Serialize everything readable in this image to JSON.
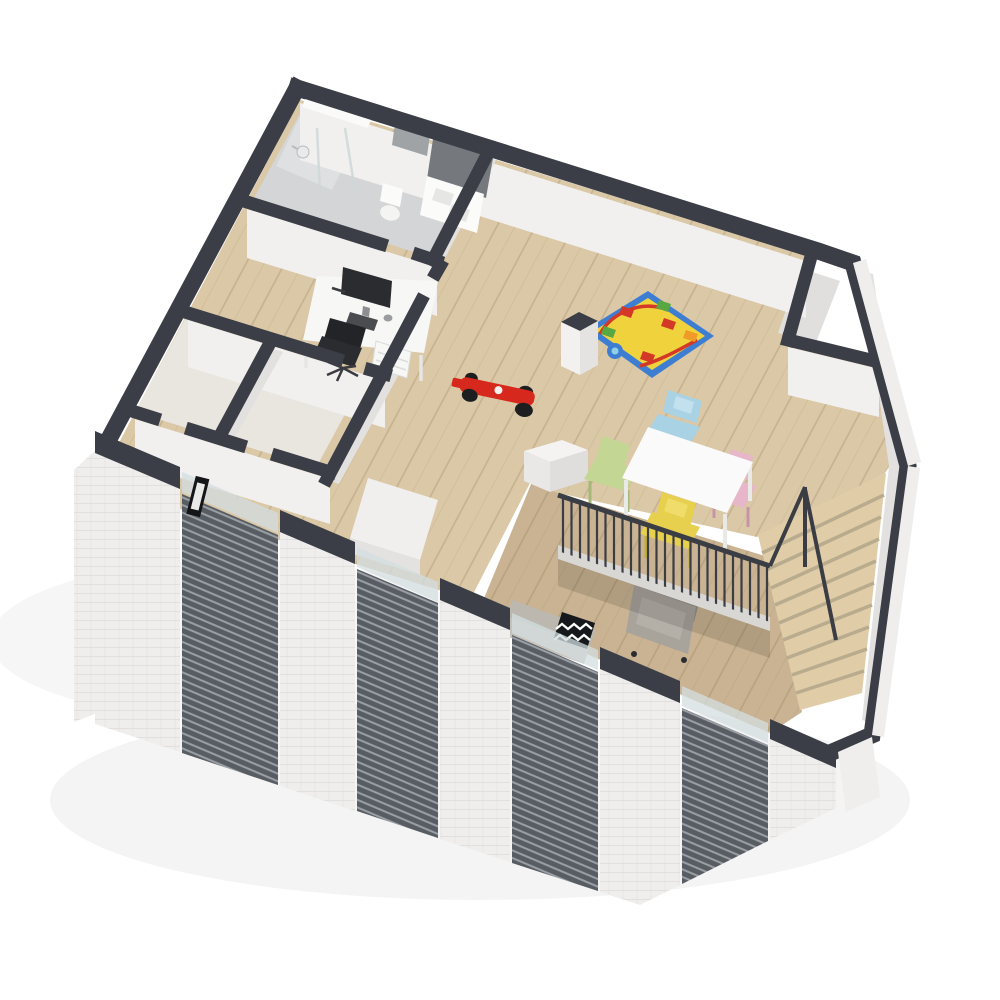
{
  "description": "3D isometric cutaway floor plan rendering of an apartment upper floor with bathroom, office, two empty rooms, play and dining area, mezzanine balustrade, staircase, lower lounge and a louvered front facade",
  "palette": {
    "wallCap": "#3b3e46",
    "wallFace": "#f1f0ee",
    "wallFaceShade": "#e2e1df",
    "exteriorWhite": "#efeeec",
    "floorWood": "#dbc8a6",
    "floorWoodLower": "#c9b392",
    "bathFloor": "#d4d5d7",
    "roomFloor": "#e9e5df",
    "closetFloor": "#e0dfdd",
    "tileDark": "#75797d",
    "fixtureWhite": "#fbfbfa",
    "deskWhite": "#f7f7f6",
    "darkFurniture": "#2b2c30",
    "louverBg": "#585c63",
    "louverLine": "#9aa0a6",
    "glass": "#d3dee0",
    "railDark": "#3a3d44",
    "stairWood": "#e0cda8",
    "stairRiser": "#b9ab8d",
    "matBlue": "#3e7ed2",
    "matYellow": "#f0d23c",
    "matRed": "#d43826",
    "matGreen": "#57a743",
    "matOrange": "#f09a28",
    "carRed": "#d6281c",
    "chairBlue": "#a9d2e4",
    "chairGreen": "#c3d694",
    "chairYellow": "#e7d04e",
    "chairPink": "#e7b6c8",
    "tableWhite": "#fafafa",
    "armchair": "#a8a39b",
    "armchairDark": "#948f87",
    "sofa": "#bcb7af",
    "pillowBlack": "#17181c",
    "mirrorGray": "#9fa3a6"
  },
  "scene": {
    "rooms": [
      {
        "name": "bathroom",
        "fixtures": [
          "shower",
          "toilet",
          "vanity",
          "mirror",
          "tile-splash"
        ]
      },
      {
        "name": "office",
        "furniture": [
          "desk",
          "monitor",
          "keyboard",
          "mouse",
          "drawer-unit",
          "office-chair"
        ]
      },
      {
        "name": "empty-room-left",
        "furniture": []
      },
      {
        "name": "empty-room-center",
        "furniture": [
          "white-closet-box"
        ]
      },
      {
        "name": "play-dining-room",
        "furniture": [
          "play-mat",
          "toy-race-car",
          "kids-table",
          "chair-blue",
          "chair-green",
          "chair-yellow",
          "chair-pink"
        ]
      },
      {
        "name": "closet-top-right",
        "furniture": []
      },
      {
        "name": "lower-lounge",
        "furniture": [
          "sofa",
          "chevron-pillow",
          "armchair"
        ]
      }
    ],
    "stairs": {
      "steps": 10
    },
    "facade": {
      "piers": 5,
      "louver_panels": 4,
      "glass_strips": 4,
      "wall_art_frames": 1
    },
    "balustrade": {
      "style": "vertical-balusters"
    }
  }
}
